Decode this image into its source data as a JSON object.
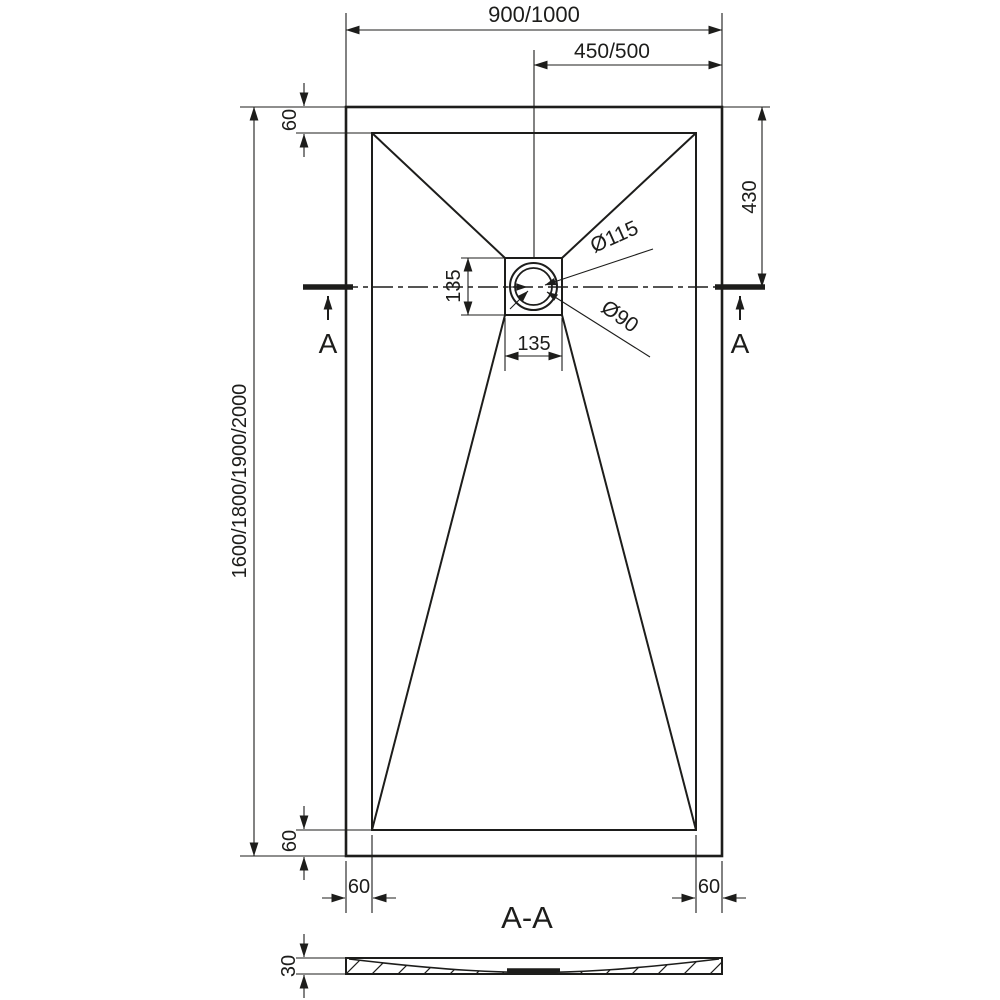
{
  "drawing": {
    "type_note": "shower-tray-technical-drawing",
    "colors": {
      "line": "#1d1d1b",
      "background": "#ffffff"
    },
    "labels": {
      "overall_width": "900/1000",
      "half_width": "450/500",
      "top_border": "60",
      "drain_offset": "430",
      "overall_length": "1600/1800/1900/2000",
      "drain_box_height": "135",
      "drain_box_width": "135",
      "flange_diameter": "Ø115",
      "drain_diameter": "Ø90",
      "section_marker_left": "A",
      "section_marker_right": "A",
      "bottom_border": "60",
      "left_border": "60",
      "right_border": "60",
      "section_title": "A-A",
      "thickness": "30"
    }
  }
}
